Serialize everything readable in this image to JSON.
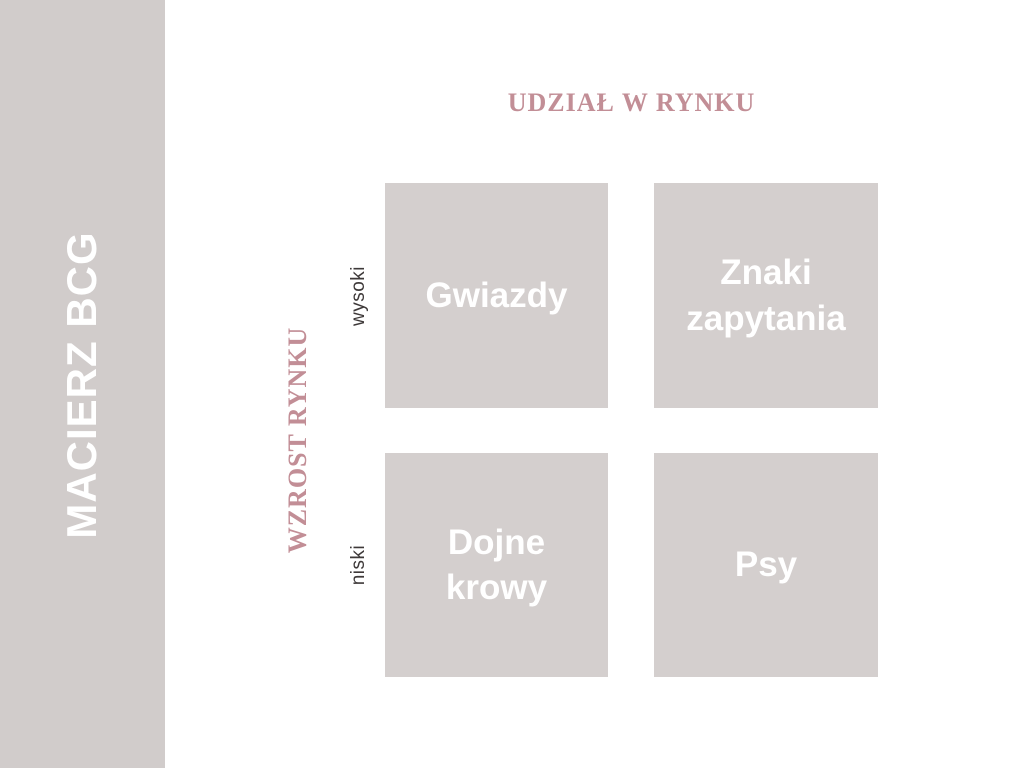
{
  "slide": {
    "background": "#ffffff"
  },
  "sidebar": {
    "title": "MACIERZ BCG",
    "background": "#d1cccb",
    "title_color": "#ffffff"
  },
  "matrix": {
    "x_axis": {
      "title": "UDZIAŁ W RYNKU"
    },
    "y_axis": {
      "title": "WZROST RYNKU",
      "high_label": "wysoki",
      "low_label": "niski"
    },
    "quadrants": [
      {
        "id": "stars",
        "label": "Gwiazdy",
        "position": "top-left",
        "row": "wysoki",
        "column": "left"
      },
      {
        "id": "question-marks",
        "label": "Znaki zapytania",
        "position": "top-right",
        "row": "wysoki",
        "column": "right"
      },
      {
        "id": "cash-cows",
        "label": "Dojne krowy",
        "position": "bottom-left",
        "row": "niski",
        "column": "left"
      },
      {
        "id": "dogs",
        "label": "Psy",
        "position": "bottom-right",
        "row": "niski",
        "column": "right"
      }
    ],
    "colors": {
      "quadrant_background": "#d4cfce",
      "quadrant_text": "#ffffff",
      "axis_title_color": "#c28e96",
      "tick_label_color": "#3e3939"
    }
  }
}
